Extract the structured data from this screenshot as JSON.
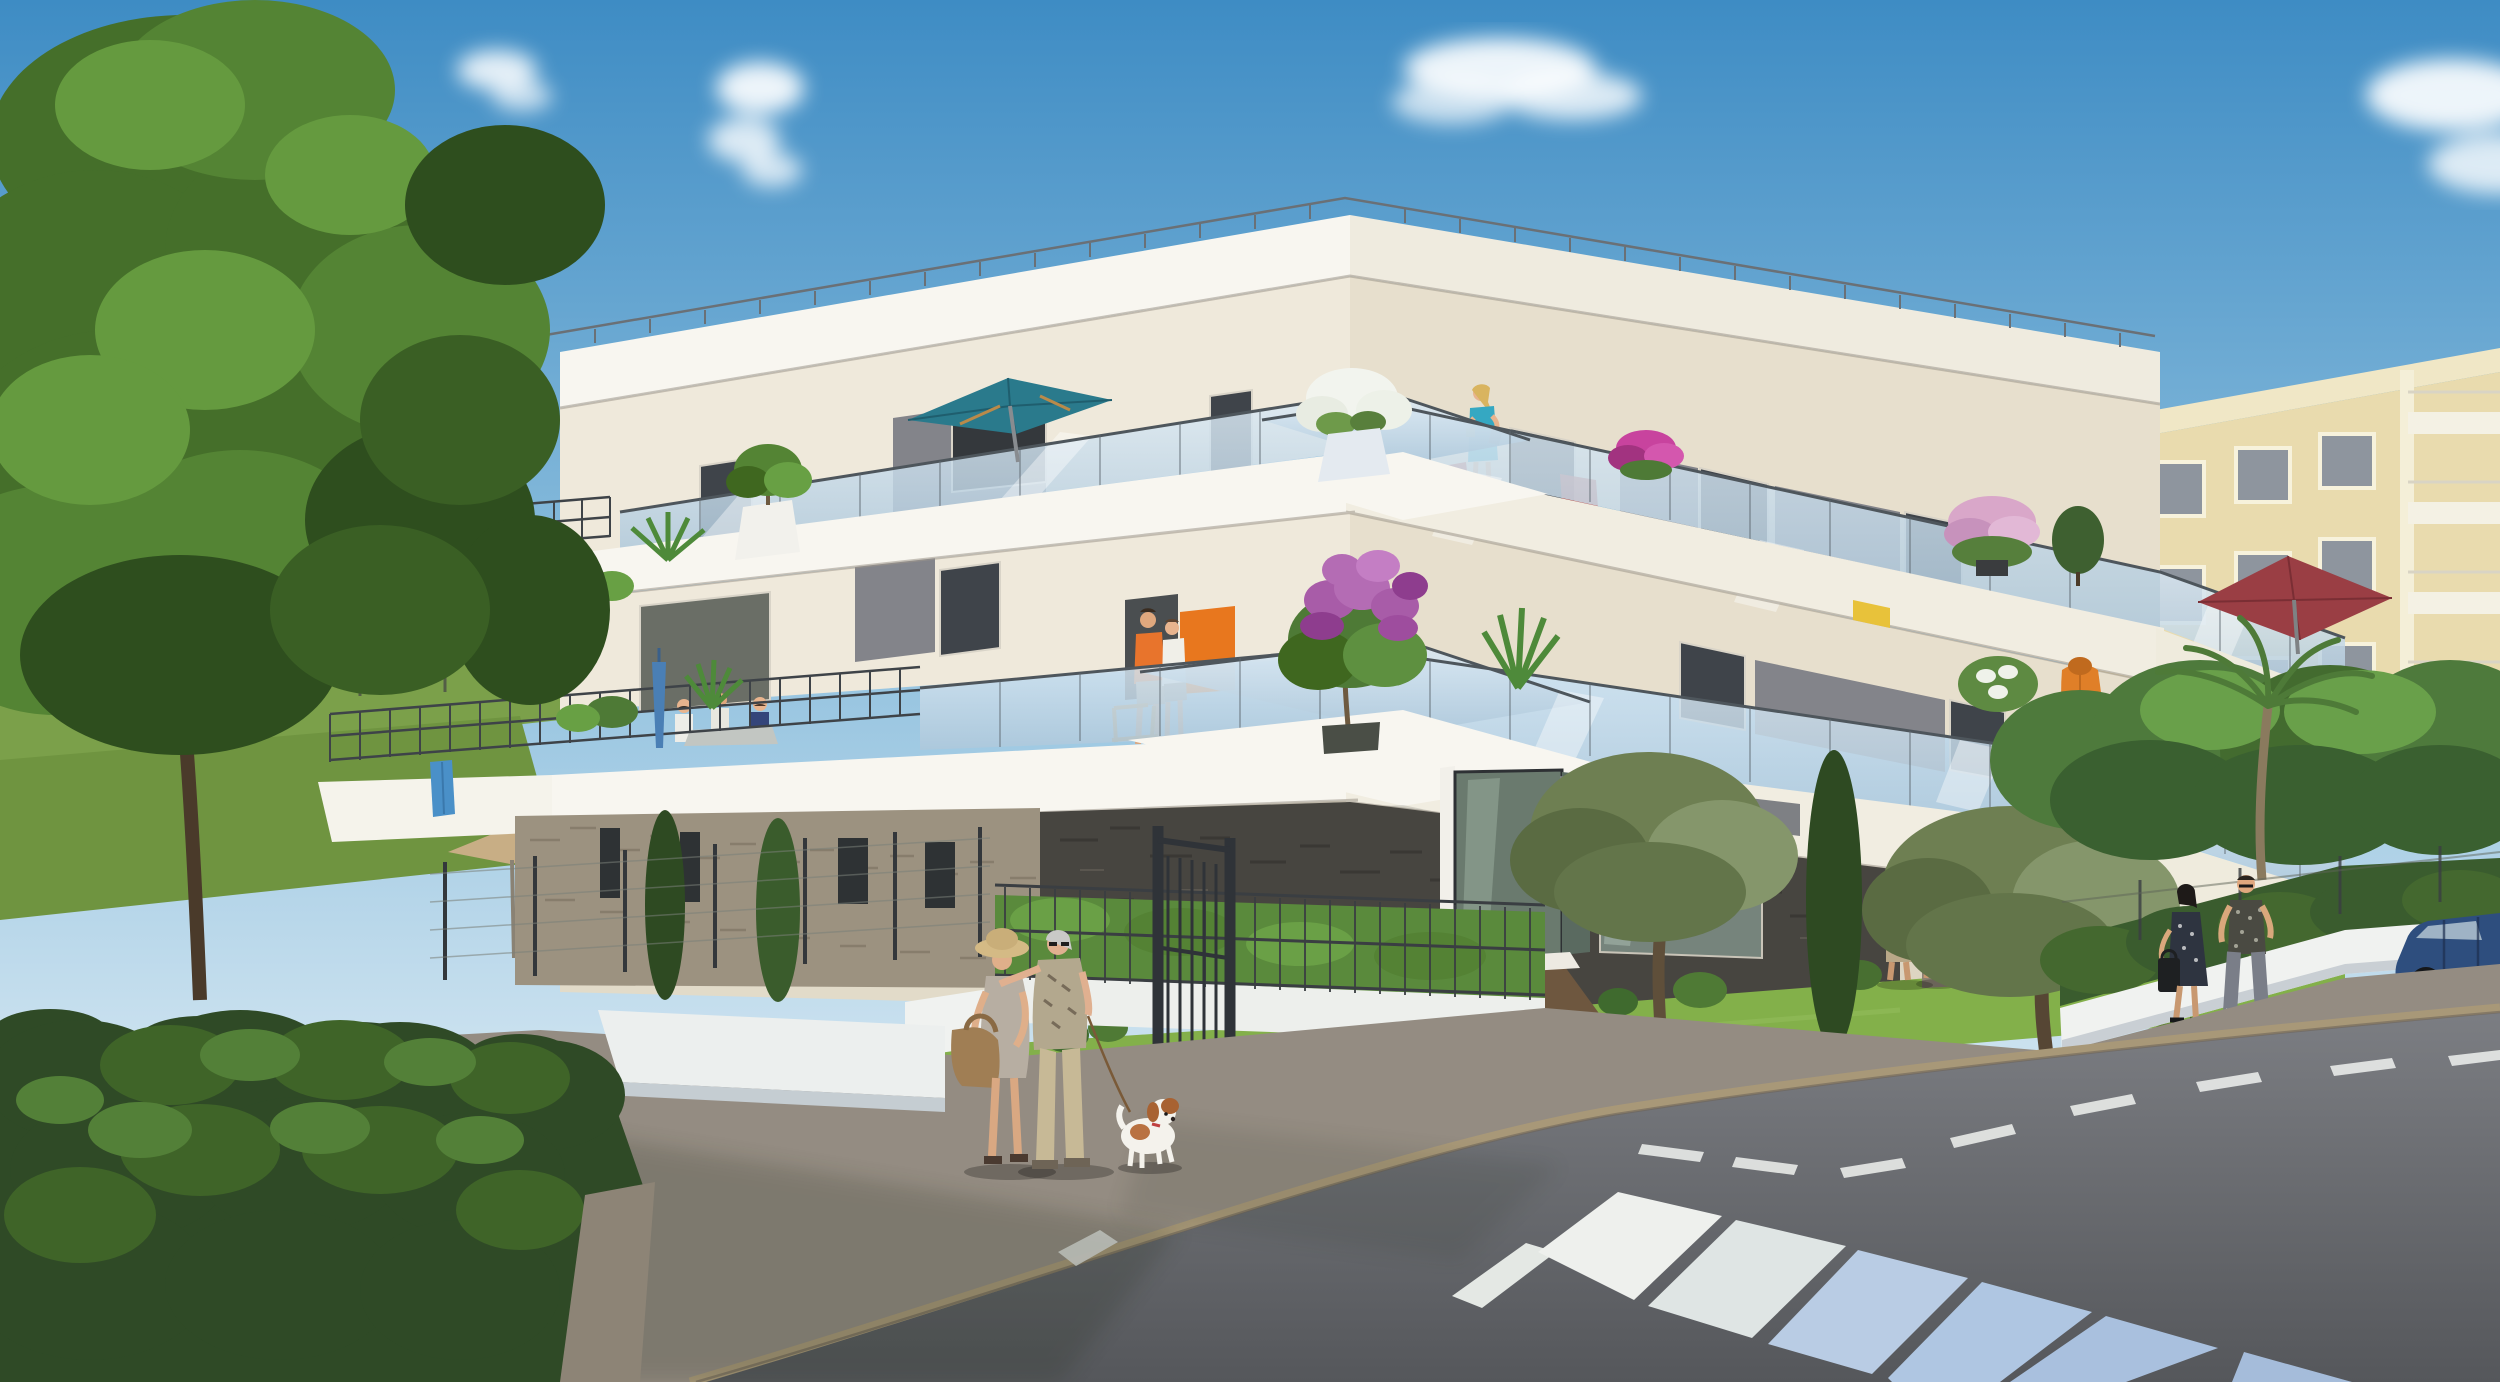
{
  "scene": {
    "type": "photorealistic 3D architectural rendering (real-estate perspective visual)",
    "setting": "new modern three-storey apartment residence on a sunny street corner with landscaped gardens, pedestrians and a zebra crosswalk",
    "weather": "clear blue sky with a few small white clouds",
    "no_visible_text": true
  },
  "building": {
    "storeys": 3,
    "style": "contemporary cream render, grey feature panels, dark schist-stone ground floor, white slab bands, frameless glass and dark metal balcony railings, roof-edge railing",
    "balcony_features": [
      "teal patio umbrella on upper-left terrace",
      "dark-red umbrella on upper-right balcony",
      "orange bathrobe hanging over a right balcony edge",
      "blue folded parasol on a left balcony",
      "blue towel on the far-left railing",
      "white pot with white flowers on the corner roof terrace",
      "magenta petunias in railing planters",
      "purple lilac shrub on the corner terrace",
      "potted palms, shrubs and small trees",
      "yellow planter box",
      "red chairs behind glass",
      "wooden chair"
    ]
  },
  "people": [
    {
      "where": "corner roof terrace",
      "who": "woman in turquoise dress reading a book with a yellow mug"
    },
    {
      "where": "first-floor corner terrace",
      "who": "man in orange polo beside woman in white top"
    },
    {
      "where": "left balcony",
      "who": "three residents seated at a table"
    },
    {
      "where": "entrance path",
      "who": "young couple walking to the door, woman with red handbag"
    },
    {
      "where": "right sidewalk",
      "who": "woman in dark polka-dot dress with black handbag"
    },
    {
      "where": "right sidewalk",
      "who": "man in printed t-shirt, grey jeans, white sneakers"
    },
    {
      "where": "foreground sidewalk",
      "who": "elderly woman with straw hat, grey dress, tan shoulder bag"
    },
    {
      "where": "foreground sidewalk",
      "who": "elderly man in patterned shirt walking the dog on a leash"
    }
  ],
  "animals": [
    {
      "type": "small spaniel, white with chestnut patches",
      "where": "foreground sidewalk on leash"
    }
  ],
  "street": {
    "features": [
      "wide light-grey sidewalk",
      "stone curb",
      "dark asphalt road",
      "zebra crosswalk of six stripes fading from white to sky-blue reflection",
      "dashed white lane line curving to the right",
      "dark metal garden fence with open gate",
      "white garden walls",
      "gabion stone wall with tall white vase",
      "parked dark-blue estate car",
      "background cream apartment building with white balconies"
    ]
  },
  "vegetation": {
    "features": [
      "large deciduous tree on the left",
      "dense clipped hedge in left foreground",
      "meadow with wire fence behind",
      "two olive trees",
      "tall cypress trees",
      "bright street hedges and shrub balls",
      "palm tree on the right",
      "beige garden parasol in the rear garden"
    ]
  },
  "palette": {
    "sky_top": "#3E8CC4",
    "sky_mid": "#8FC0DE",
    "sky_horizon": "#DCEBF4",
    "cloud": "#FFFFFF",
    "wall_cream": "#EFE9DB",
    "wall_cream_shade": "#DFD6C2",
    "slab_white": "#F8F6F0",
    "panel_grey": "#83848A",
    "stone_dark": "#474540",
    "stone_beige": "#9C9280",
    "glass_blue": "#C7DCEB",
    "railing_metal": "#3E4348",
    "umbrella_teal": "#2A7A8C",
    "umbrella_maroon": "#9A3E44",
    "parasol_beige": "#C8AE85",
    "parasol_blue": "#4A7FB5",
    "robe_orange": "#E07F28",
    "towel_blue": "#4A90C8",
    "flowers_magenta": "#C8439E",
    "flowers_pink": "#D9A7C9",
    "lilac_purple": "#A85CA8",
    "flowers_white": "#F2F4EE",
    "grass": "#83B04A",
    "tree_green": "#548434",
    "hedge_dark": "#2F4A26",
    "road_asphalt": "#5E6064",
    "sidewalk": "#948C82",
    "curb": "#A89878",
    "crosswalk_white": "#EEF0ED",
    "crosswalk_blue": "#AFC6E2",
    "car_blue": "#2E4E7E",
    "dog_white": "#F4F2EC",
    "dog_chestnut": "#A86232"
  }
}
